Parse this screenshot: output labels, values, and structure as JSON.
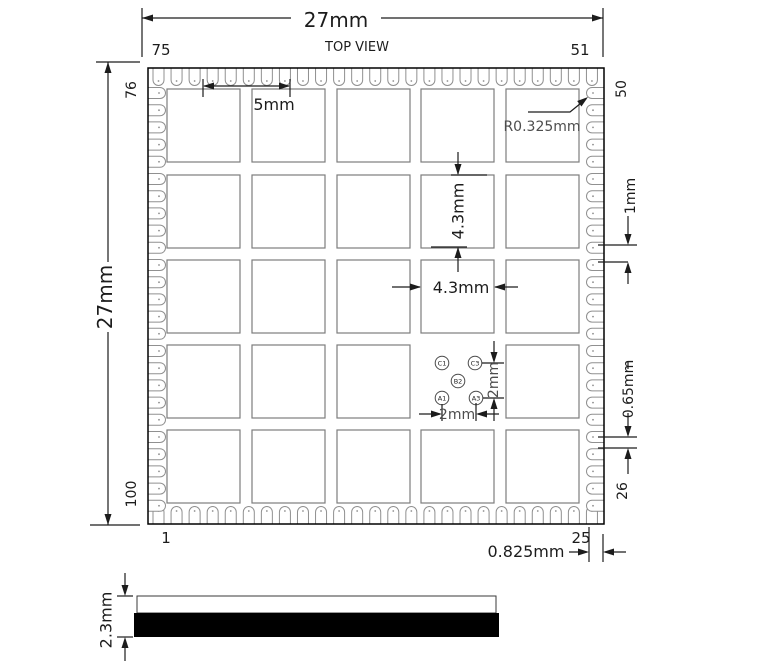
{
  "colors": {
    "line": "#1c1c1c",
    "pad_stroke": "#909090",
    "grid_stroke": "#7d7d7d",
    "outline": "#000000",
    "side_body_fill": "#000000",
    "background": "#ffffff"
  },
  "top_view": {
    "title": "TOP VIEW",
    "dim_overall_width": "27mm",
    "dim_overall_height": "27mm",
    "dim_grid_pitch": "5mm",
    "dim_grid_pad_height": "4.3mm",
    "dim_grid_pad_width": "4.3mm",
    "dim_corner_pad_radius": "R0.325mm",
    "dim_edge_pad_pitch": "1mm",
    "dim_edge_pad_width": "0.65mm",
    "dim_ball_pitch_vertical": "2mm",
    "dim_ball_pitch_horizontal": "2mm",
    "dim_edge_clearance": "0.825mm",
    "pins": {
      "top_left": "75",
      "top_right": "51",
      "right_top": "50",
      "right_bottom": "26",
      "bottom_left": "1",
      "bottom_right": "25",
      "left_top": "76",
      "left_bottom": "100"
    },
    "balls": [
      "C1",
      "C3",
      "B2",
      "A1",
      "A3"
    ]
  },
  "side_view": {
    "dim_thickness": "2.3mm"
  }
}
